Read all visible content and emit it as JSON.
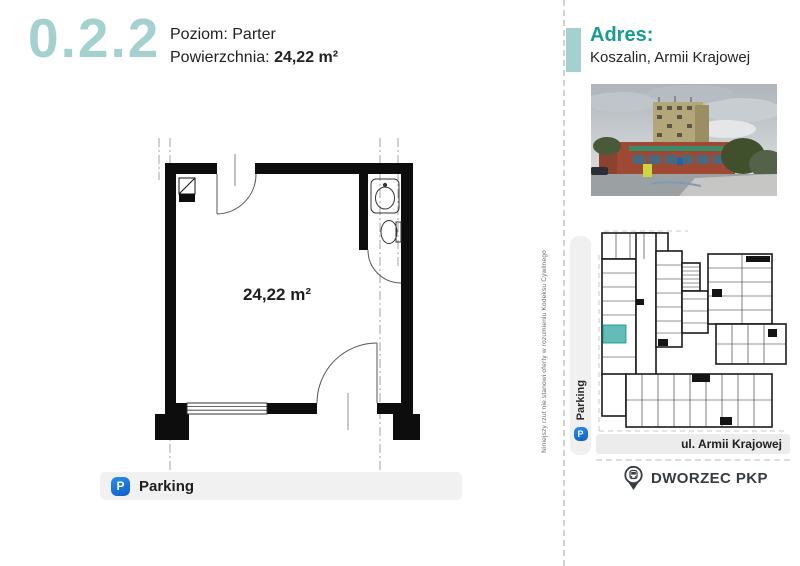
{
  "header": {
    "unit_number": "0.2.2",
    "level_label": "Poziom:",
    "level_value": "Parter",
    "area_label": "Powierzchnia:",
    "area_value": "24,22 m²"
  },
  "floor_plan": {
    "area_text": "24,22 m²"
  },
  "amenities": {
    "parking_label": "Parking",
    "parking_icon_letter": "P"
  },
  "sidebar": {
    "address_label": "Adres:",
    "address_value": "Koszalin, Armii Krajowej",
    "site_plan": {
      "parking_label": "Parking",
      "parking_icon_letter": "P",
      "street_label": "ul. Armii Krajowej",
      "station_label": "DWORZEC PKP"
    }
  },
  "disclaimer": "Niniejszy rzut nie stanowi oferty w rozumieniu Kodeksu Cywilnego",
  "colors": {
    "teal_light": "#a4d1cf",
    "teal_dark": "#1a9a96",
    "unit_highlight": "#63bcb8",
    "parking_blue": "#1c72d2",
    "text_dark": "#1f1f1f"
  }
}
